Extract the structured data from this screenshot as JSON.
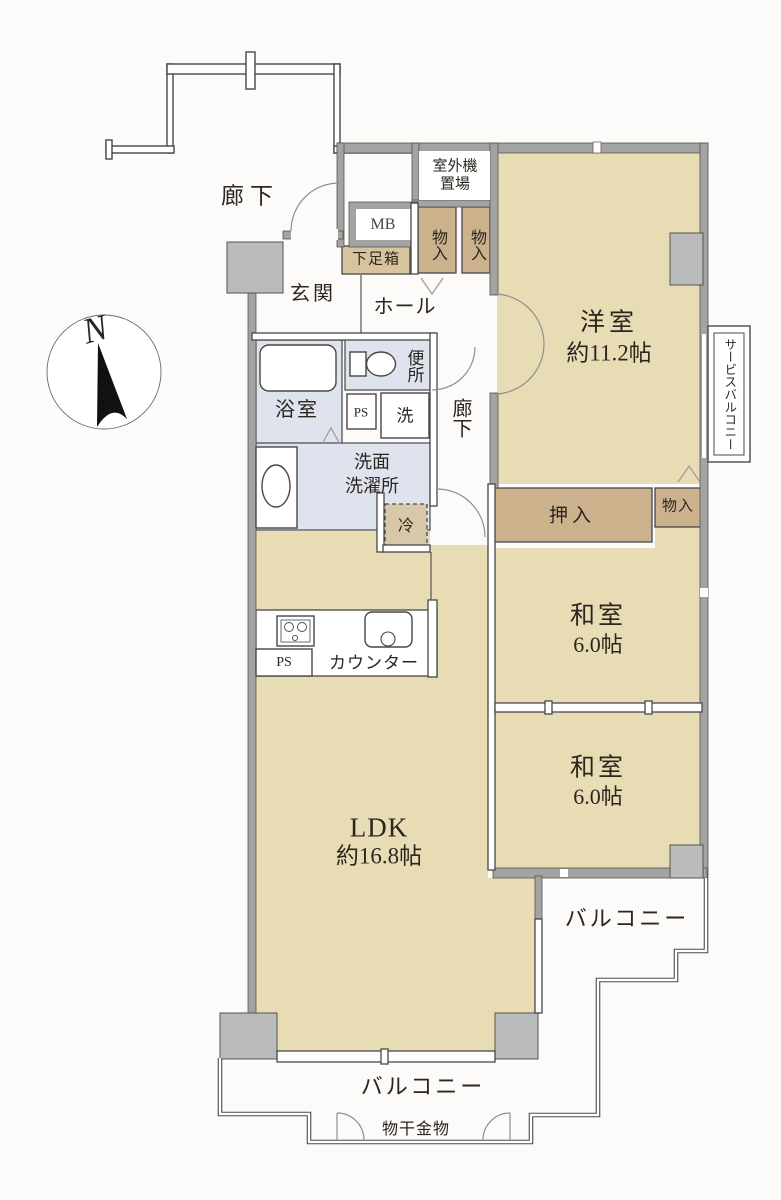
{
  "page": {
    "width": 781,
    "height": 1200,
    "background": "#fcfbf9"
  },
  "colors": {
    "room_fill": "#e8dcb5",
    "storage_fill": "#cbb28c",
    "shoe_box_fill": "#d8c49c",
    "wet_area_fill": "#dfe3ed",
    "wall_gray": "#a3a3a3",
    "pillar_gray": "#b9bbbd",
    "outline": "#474747",
    "text": "#2b2620"
  },
  "compass": {
    "north_label": "N"
  },
  "shared_corridor": {
    "label": "廊下"
  },
  "entrance_area": {
    "entrance": "玄関",
    "hall": "ホール",
    "shoe_box": "下足箱",
    "meter_box": "MB",
    "outdoor_unit_line1": "室外機",
    "outdoor_unit_line2": "置場",
    "storage_a": "物入",
    "storage_b": "物入"
  },
  "corridor": {
    "label": "廊下"
  },
  "sanitary": {
    "bathroom": "浴室",
    "toilet": "便所",
    "washroom_line1": "洗面",
    "washroom_line2": "洗濯所",
    "washer": "洗",
    "pipe_space": "PS"
  },
  "kitchen": {
    "counter": "カウンター",
    "pipe_space": "PS",
    "refrigerator": "冷"
  },
  "rooms": {
    "western": {
      "name": "洋室",
      "size": "約11.2帖"
    },
    "japanese1": {
      "name": "和室",
      "size": "6.0帖"
    },
    "japanese2": {
      "name": "和室",
      "size": "6.0帖"
    },
    "ldk": {
      "name": "LDK",
      "size": "約16.8帖"
    },
    "closet": "押入",
    "storage": "物入"
  },
  "balcony": {
    "service": "サービスバルコニー",
    "east": "バルコニー",
    "south": "バルコニー",
    "laundry_hardware": "物干金物"
  }
}
